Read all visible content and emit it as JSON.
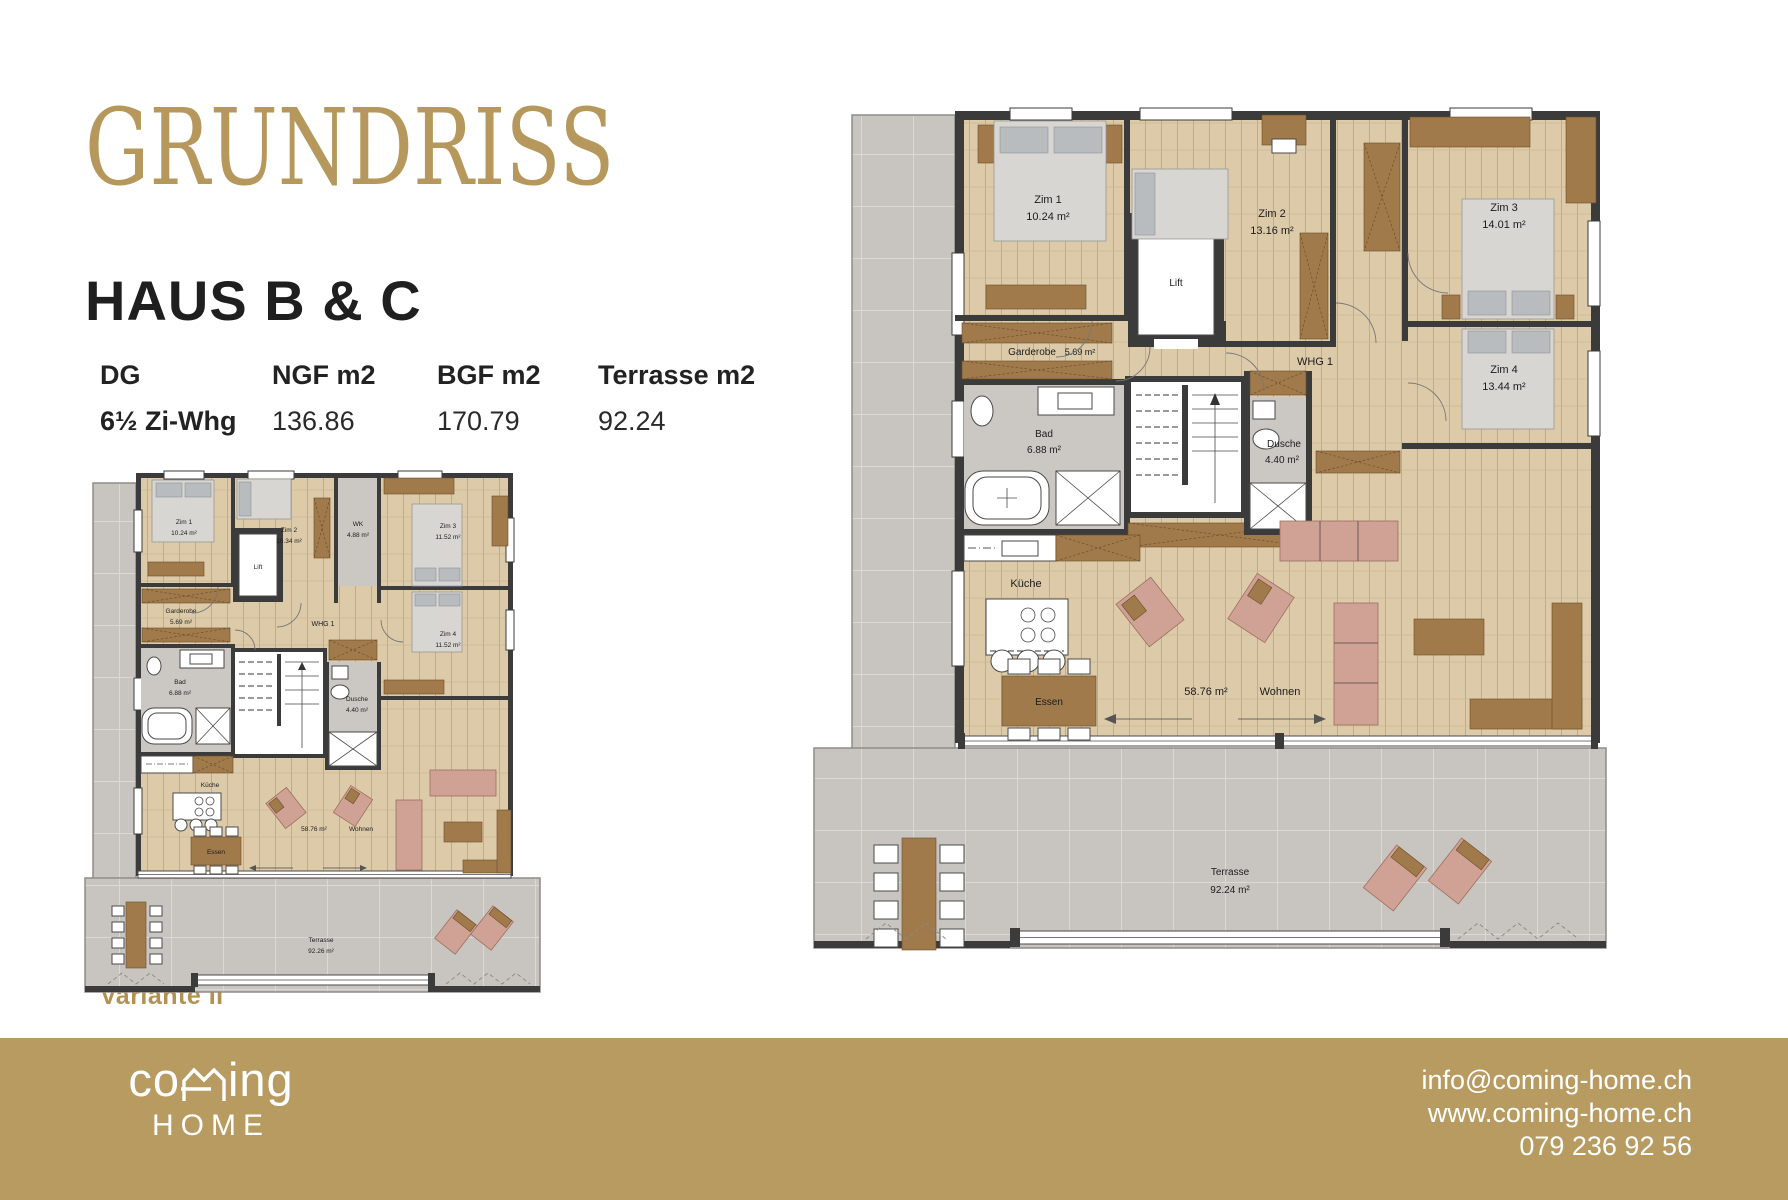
{
  "header": {
    "title": "GRUNDRISS",
    "subtitle": "HAUS B & C"
  },
  "table": {
    "col_floor": "DG",
    "col_ngf": "NGF m2",
    "col_bgf": "BGF m2",
    "col_terrasse": "Terrasse m2",
    "row": {
      "type": "6½ Zi-Whg",
      "ngf": "136.86",
      "bgf": "170.79",
      "terrasse": "92.24"
    }
  },
  "variant_label": "Variante II",
  "large_plan": {
    "rooms": {
      "zim1": {
        "name": "Zim 1",
        "area": "10.24 m²"
      },
      "zim2": {
        "name": "Zim 2",
        "area": "13.16 m²"
      },
      "zim3": {
        "name": "Zim 3",
        "area": "14.01 m²"
      },
      "zim4": {
        "name": "Zim 4",
        "area": "13.44 m²"
      },
      "garderobe": {
        "name": "Garderobe",
        "area": "5.69 m²"
      },
      "bad": {
        "name": "Bad",
        "area": "6.88 m²"
      },
      "dusche": {
        "name": "Dusche",
        "area": "4.40 m²"
      },
      "kueche": {
        "name": "Küche"
      },
      "essen": {
        "name": "Essen"
      },
      "wohnen": {
        "name": "Wohnen",
        "area": "58.76 m²"
      },
      "lift": {
        "name": "Lift"
      },
      "whg": {
        "name": "WHG 1"
      },
      "terrasse": {
        "name": "Terrasse",
        "area": "92.24 m²"
      }
    }
  },
  "small_plan": {
    "rooms": {
      "zim1": {
        "name": "Zim 1",
        "area": "10.24 m²"
      },
      "zim2": {
        "name": "Zim 2",
        "area": "10.34 m²"
      },
      "wk": {
        "name": "WK",
        "area": "4.88 m²"
      },
      "zim3": {
        "name": "Zim 3",
        "area": "11.52 m²"
      },
      "zim4": {
        "name": "Zim 4",
        "area": "11.52 m²"
      },
      "garderobe": {
        "name": "Garderobe",
        "area": "5.69 m²"
      },
      "bad": {
        "name": "Bad",
        "area": "6.88 m²"
      },
      "dusche": {
        "name": "Dusche",
        "area": "4.40 m²"
      },
      "kueche": {
        "name": "Küche"
      },
      "essen": {
        "name": "Essen"
      },
      "wohnen": {
        "name": "Wohnen",
        "area": "58.76 m²"
      },
      "lift": {
        "name": "Lift"
      },
      "whg": {
        "name": "WHG 1"
      },
      "terrasse": {
        "name": "Terrasse",
        "area": "92.26 m²"
      }
    }
  },
  "footer": {
    "logo_co": "co",
    "logo_ing": "ing",
    "logo_home": "HOME",
    "email": "info@coming-home.ch",
    "website": "www.coming-home.ch",
    "phone": "079 236 92 56"
  },
  "colors": {
    "accent_gold": "#b6985c",
    "footer_gold": "#b79b61",
    "wall": "#3b3b3b",
    "wood_floor": "#dccaa9",
    "terrace_gray": "#c8c5c0"
  }
}
